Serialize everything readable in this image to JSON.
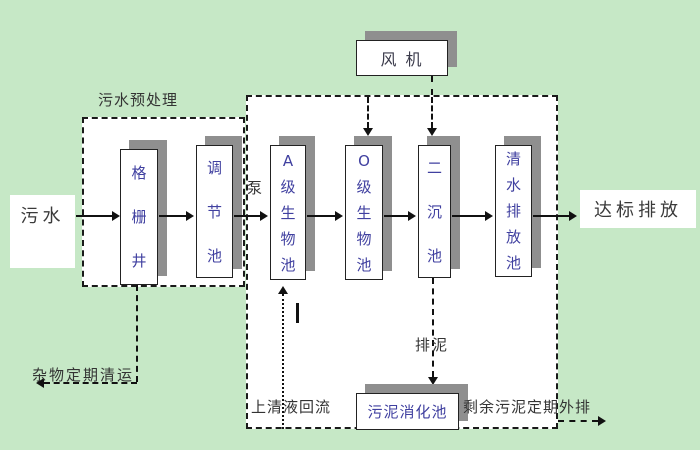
{
  "colors": {
    "background": "#c6e8c6",
    "box_fill": "#ffffff",
    "box_border": "#222222",
    "shadow": "#8f8f8f",
    "box_text": "#4040a0",
    "label_text": "#333333",
    "line": "#111111"
  },
  "nodes": {
    "influent": "污水",
    "grid_well": "格栅井",
    "regulating_tank": "调节池",
    "a_bio_tank": "A级生物池",
    "o_bio_tank": "O级生物池",
    "secondary_clarifier": "二沉池",
    "clear_water_tank": "清水排放池",
    "blower": "风 机",
    "sludge_digester": "污泥消化池",
    "effluent": "达标排放"
  },
  "annotations": {
    "pretreatment_title": "污水预处理",
    "pump": "泵",
    "debris_removal": "杂物定期清运",
    "supernatant_return": "上清液回流",
    "sludge_discharge": "排泥",
    "excess_sludge_out": "剩余污泥定期外排"
  }
}
